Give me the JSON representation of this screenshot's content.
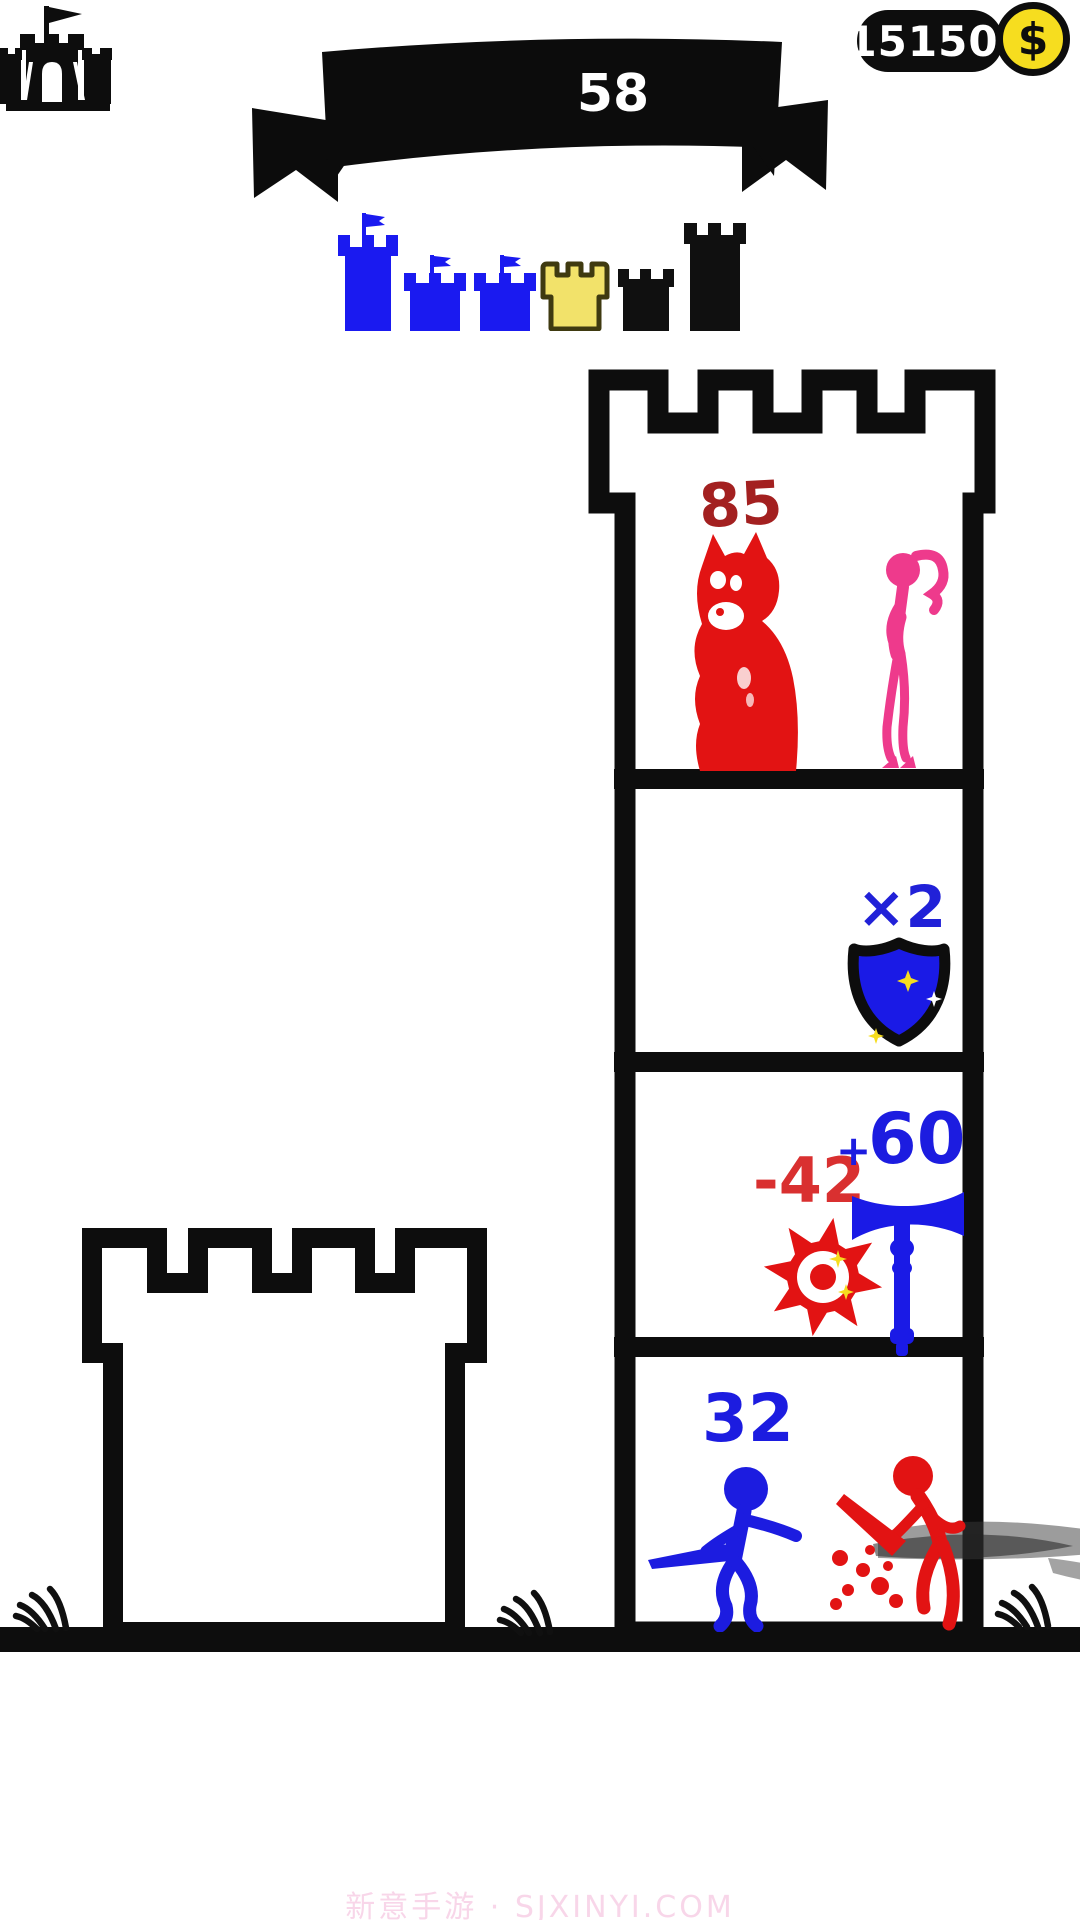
{
  "hud": {
    "coins": "15150",
    "coin_symbol": "$",
    "level": "58"
  },
  "progress": {
    "items": [
      {
        "name": "castle-large-flag",
        "state": "completed",
        "color": "#1a1af0"
      },
      {
        "name": "castle-small-flag",
        "state": "completed",
        "color": "#1a1af0"
      },
      {
        "name": "castle-small-flag",
        "state": "completed",
        "color": "#1a1af0"
      },
      {
        "name": "castle-current",
        "state": "current",
        "color": "#f2e26a"
      },
      {
        "name": "castle-small",
        "state": "locked",
        "color": "#101010"
      },
      {
        "name": "tower-tall",
        "state": "locked",
        "color": "#101010"
      }
    ]
  },
  "tower": {
    "floor_top": {
      "enemy_hp": "85",
      "occupants": [
        "red-monster",
        "pink-princess"
      ]
    },
    "floor_shield": {
      "multiplier": "×2",
      "occupants": [
        "shield-powerup"
      ]
    },
    "floor_weapons": {
      "debuff": "-42",
      "buff_sign": "+",
      "buff_value": "60",
      "occupants": [
        "red-saw-trap",
        "blue-hammer-weapon"
      ]
    },
    "floor_battle": {
      "hero_hp": "32",
      "occupants": [
        "blue-hero",
        "red-enemy-hit"
      ]
    }
  },
  "watermark": "新意手游 · SJXINYI.COM",
  "colors": {
    "ink": "#0d0d0d",
    "blue": "#1a1ae6",
    "red": "#e21313",
    "dark_red": "#a32020",
    "pink": "#ee3a8c",
    "gold_coin": "#f6dd1f",
    "castle_yellow": "#f2e26a",
    "castle_yellow_outline": "#3f3a10",
    "watermark_pink": "#f6c8e1"
  }
}
